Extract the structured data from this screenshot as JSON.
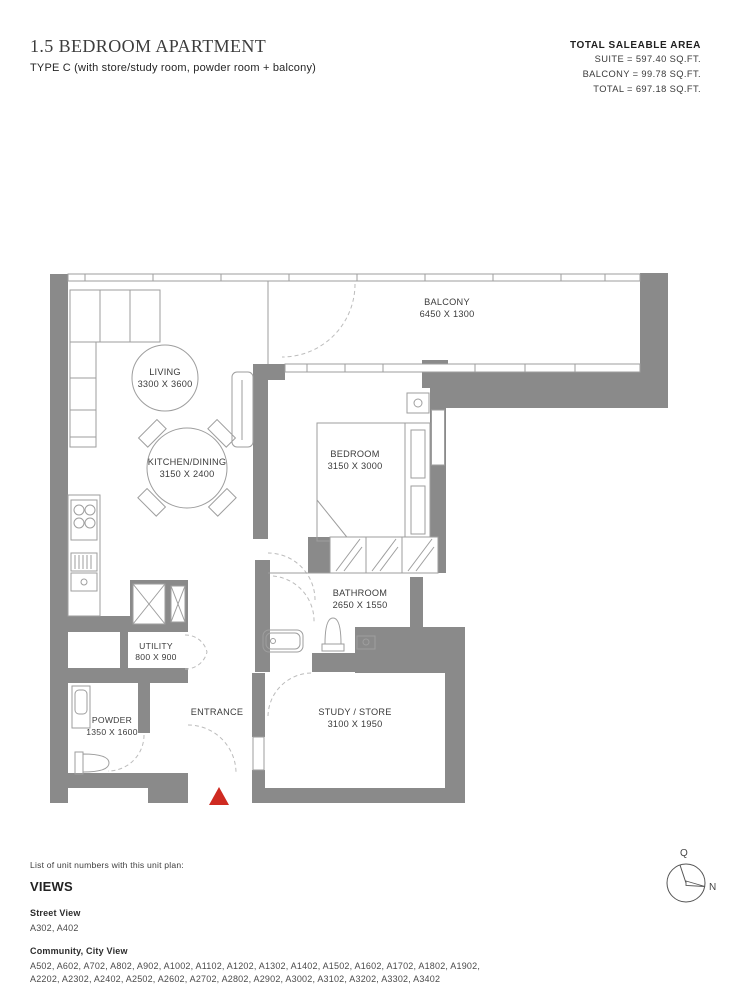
{
  "header": {
    "title": "1.5 BEDROOM APARTMENT",
    "subtitle": "TYPE C (with store/study room, powder room + balcony)"
  },
  "area_summary": {
    "heading": "TOTAL SALEABLE AREA",
    "lines": [
      "SUITE = 597.40 SQ.FT.",
      "BALCONY = 99.78 SQ.FT.",
      "TOTAL = 697.18 SQ.FT."
    ]
  },
  "plan": {
    "rooms": [
      {
        "name": "LIVING",
        "dims": "3300 X 3600"
      },
      {
        "name": "KITCHEN/DINING",
        "dims": "3150 X 2400"
      },
      {
        "name": "BALCONY",
        "dims": "6450 X 1300"
      },
      {
        "name": "BEDROOM",
        "dims": "3150 X 3000"
      },
      {
        "name": "BATHROOM",
        "dims": "2650 X 1550"
      },
      {
        "name": "UTILITY",
        "dims": "800 X 900"
      },
      {
        "name": "POWDER",
        "dims": "1350 X 1600"
      },
      {
        "name": "STUDY / STORE",
        "dims": "3100 X 1950"
      },
      {
        "name": "ENTRANCE",
        "dims": ""
      }
    ],
    "compass": {
      "qibla_label": "Q",
      "north_label": "N"
    },
    "colors": {
      "wall": "#8a8a8a",
      "line": "#9e9e9e",
      "dash": "#bcbcbc",
      "text": "#3b3b3b",
      "entrance_marker": "#cf2a21"
    }
  },
  "footer": {
    "intro": "List of unit numbers with this unit plan:",
    "views_heading": "VIEWS",
    "groups": [
      {
        "label": "Street View",
        "units": "A302, A402"
      },
      {
        "label": "Community, City View",
        "units": "A502, A602, A702, A802, A902, A1002, A1102, A1202, A1302, A1402, A1502, A1602, A1702, A1802, A1902, A2202, A2302, A2402, A2502, A2602, A2702, A2802, A2902, A3002, A3102, A3202, A3302, A3402"
      }
    ]
  }
}
